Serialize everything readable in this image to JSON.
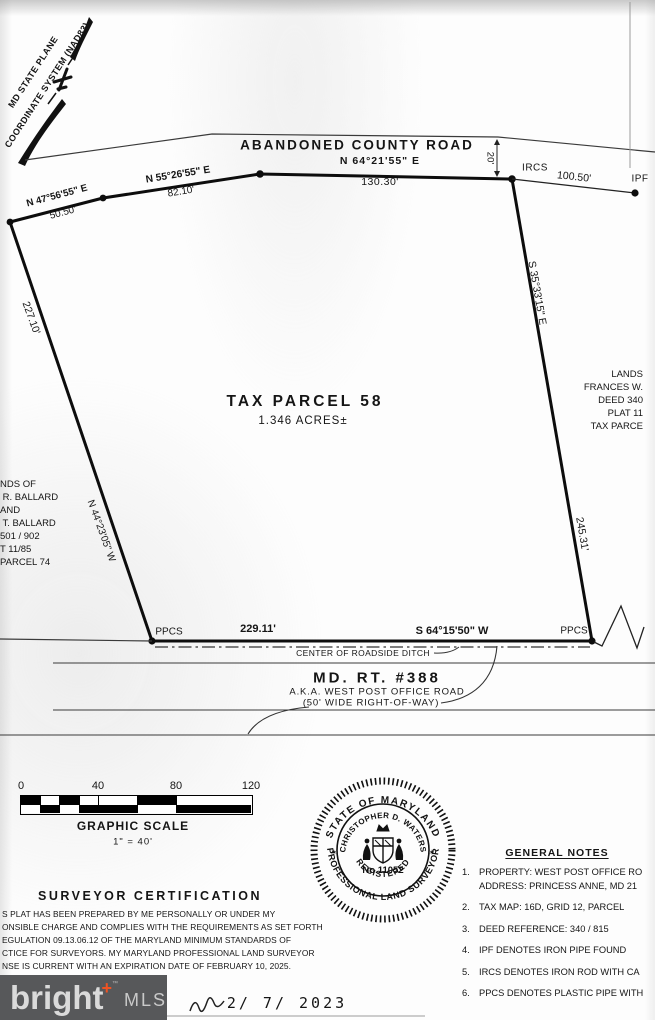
{
  "compass": {
    "line1": "MD STATE PLANE",
    "line2": "COORDINATE SYSTEM (NAD83)"
  },
  "top_road": {
    "name": "ABANDONED COUNTY ROAD",
    "width": "20'"
  },
  "bearings": {
    "nw1": {
      "bearing": "N 47°56'55\" E",
      "distance": "50.50'"
    },
    "nw2": {
      "bearing": "N 55°26'55\" E",
      "distance": "82.10'"
    },
    "north": {
      "bearing": "N 64°21'55\" E",
      "distance": "130.30'"
    },
    "east": {
      "bearing": "S 35°33'15\" E",
      "distance": "245.31'"
    },
    "south": {
      "bearing": "S 64°15'50\" W",
      "distance": "229.11'"
    },
    "west": {
      "bearing": "N 44°23'05\" W",
      "distance": "227.10'"
    }
  },
  "tie": {
    "distance": "100.50'"
  },
  "monuments": {
    "ircs": "IRCS",
    "ipf": "IPF",
    "ppcs_left": "PPCS",
    "ppcs_right": "PPCS"
  },
  "parcel": {
    "title": "TAX PARCEL 58",
    "area": "1.346 ACRES±"
  },
  "neighbors": {
    "west_lines": [
      "NDS OF",
      " R. BALLARD",
      "AND",
      " T. BALLARD",
      "501 / 902",
      "T 11/85",
      "PARCEL 74"
    ],
    "east_lines": [
      "LANDS",
      "FRANCES W.",
      "DEED 340",
      "PLAT 11",
      "TAX PARCE"
    ]
  },
  "ditch": {
    "label": "CENTER OF ROADSIDE DITCH"
  },
  "md_route": {
    "name": "MD. RT. #388",
    "aka": "A.K.A. WEST POST OFFICE ROAD",
    "row": "(50' WIDE RIGHT-OF-WAY)"
  },
  "scale": {
    "ticks": [
      "0",
      "40",
      "80",
      "120"
    ],
    "title": "GRAPHIC SCALE",
    "equation": "1\" = 40'"
  },
  "certification": {
    "title": "SURVEYOR CERTIFICATION",
    "lines": [
      "S PLAT HAS BEEN PREPARED BY ME PERSONALLY OR UNDER MY",
      "ONSIBLE CHARGE AND COMPLIES WITH THE REQUIREMENTS AS SET FORTH",
      "EGULATION 09.13.06.12 OF THE MARYLAND MINIMUM STANDARDS OF",
      "CTICE FOR SURVEYORS. MY MARYLAND PROFESSIONAL LAND SURVEYOR",
      "NSE IS CURRENT WITH AN EXPIRATION DATE OF FEBRUARY 10, 2025."
    ]
  },
  "seal": {
    "outer_top": "STATE OF MARYLAND",
    "outer_bottom": "PROFESSIONAL LAND SURVEYOR",
    "inner_top": "CHRISTOPHER D. WATERS",
    "number": "No.11052",
    "inner_bottom": "REGISTERED",
    "star": "✶"
  },
  "notes": {
    "title": "GENERAL NOTES",
    "items": [
      {
        "num": "1.",
        "lines": [
          "PROPERTY: WEST POST OFFICE RO",
          "ADDRESS: PRINCESS ANNE, MD 21"
        ]
      },
      {
        "num": "2.",
        "lines": [
          "TAX MAP: 16D, GRID 12, PARCEL"
        ]
      },
      {
        "num": "3.",
        "lines": [
          "DEED REFERENCE: 340 / 815"
        ]
      },
      {
        "num": "4.",
        "lines": [
          "IPF DENOTES IRON PIPE FOUND"
        ]
      },
      {
        "num": "5.",
        "lines": [
          "IRCS DENOTES IRON ROD WITH CA"
        ]
      },
      {
        "num": "6.",
        "lines": [
          "PPCS DENOTES PLASTIC PIPE WITH"
        ]
      }
    ]
  },
  "watermark": {
    "brand": "bright",
    "plus": "+",
    "tm": "™",
    "suffix": "MLS"
  },
  "footer": {
    "date": "2/ 7/ 2023"
  }
}
